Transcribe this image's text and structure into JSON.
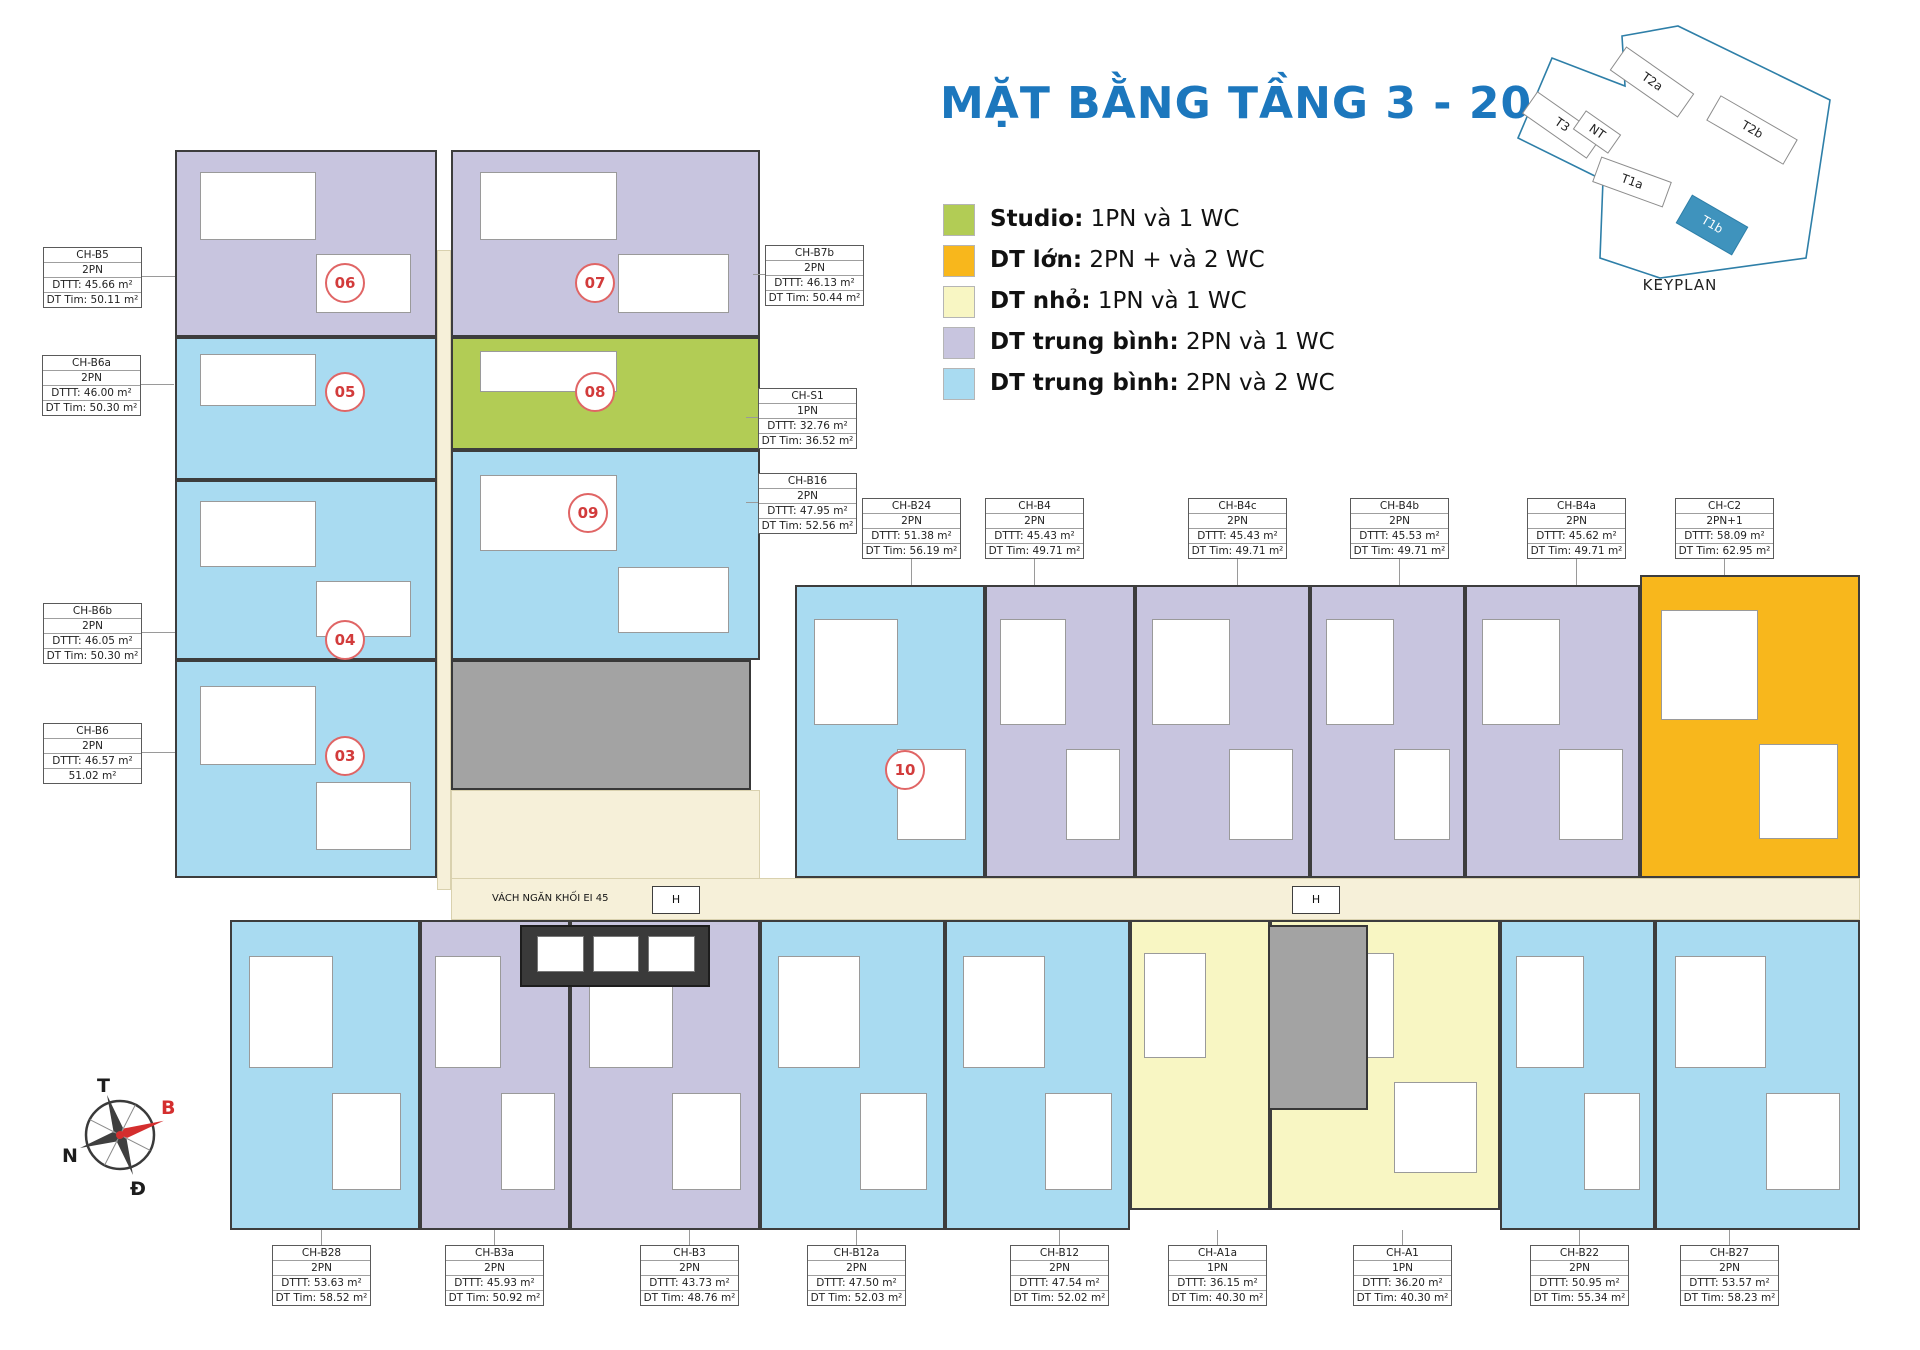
{
  "title": "MẶT BẰNG TẦNG 3 - 20",
  "title_color": "#1c77bd",
  "colors": {
    "studio": "#b2cc55",
    "large": "#f8b71c",
    "small": "#f8f6c3",
    "medium_1wc": "#c8c5df",
    "medium_2wc": "#a9dbf1",
    "core": "#a3a3a3",
    "corridor": "#f6f0d9",
    "elevator": "#3a3a3a"
  },
  "legend": {
    "items": [
      {
        "cat": "studio",
        "bold": "Studio:",
        "text": " 1PN và 1 WC"
      },
      {
        "cat": "large",
        "bold": "DT lớn:",
        "text": " 2PN + và 2 WC"
      },
      {
        "cat": "small",
        "bold": "DT nhỏ:",
        "text": " 1PN và 1 WC"
      },
      {
        "cat": "medium_1wc",
        "bold": "DT trung bình:",
        "text": " 2PN và 1 WC"
      },
      {
        "cat": "medium_2wc",
        "bold": "DT trung bình:",
        "text": " 2PN và 2 WC"
      }
    ]
  },
  "keyplan": {
    "caption": "KEYPLAN",
    "buildings": [
      "T3",
      "NT",
      "T2a",
      "T1a",
      "T2b",
      "T1b"
    ],
    "highlighted": "T1b",
    "highlight_color": "#3f93bd",
    "outline_color": "#2e7fa8"
  },
  "compass": {
    "top": "T",
    "right": "B",
    "left": "N",
    "bottom": "Đ",
    "needle_color": "#d42e2e"
  },
  "apartments": [
    {
      "id": "CH-B5",
      "type": "2PN",
      "dttt": "DTTT: 45.66 m²",
      "dttim": "DT Tim: 50.11 m²",
      "x": 43,
      "y": 247,
      "leader": "right"
    },
    {
      "id": "CH-B6a",
      "type": "2PN",
      "dttt": "DTTT: 46.00 m²",
      "dttim": "DT Tim: 50.30 m²",
      "x": 42,
      "y": 355,
      "leader": "right"
    },
    {
      "id": "CH-B6b",
      "type": "2PN",
      "dttt": "DTTT: 46.05 m²",
      "dttim": "DT Tim: 50.30 m²",
      "x": 43,
      "y": 603,
      "leader": "right"
    },
    {
      "id": "CH-B6",
      "type": "2PN",
      "dttt": "DTTT: 46.57 m²",
      "dttim": "51.02 m²",
      "x": 43,
      "y": 723,
      "leader": "right"
    },
    {
      "id": "CH-B7b",
      "type": "2PN",
      "dttt": "DTTT: 46.13 m²",
      "dttim": "DT Tim: 50.44 m²",
      "x": 765,
      "y": 245,
      "leader": "left"
    },
    {
      "id": "CH-S1",
      "type": "1PN",
      "dttt": "DTTT: 32.76 m²",
      "dttim": "DT Tim: 36.52 m²",
      "x": 758,
      "y": 388,
      "leader": "left"
    },
    {
      "id": "CH-B16",
      "type": "2PN",
      "dttt": "DTTT: 47.95 m²",
      "dttim": "DT Tim: 52.56 m²",
      "x": 758,
      "y": 473,
      "leader": "left"
    },
    {
      "id": "CH-B24",
      "type": "2PN",
      "dttt": "DTTT: 51.38 m²",
      "dttim": "DT Tim: 56.19 m²",
      "x": 862,
      "y": 498,
      "leader": "down"
    },
    {
      "id": "CH-B4",
      "type": "2PN",
      "dttt": "DTTT: 45.43 m²",
      "dttim": "DT Tim: 49.71 m²",
      "x": 985,
      "y": 498,
      "leader": "down"
    },
    {
      "id": "CH-B4c",
      "type": "2PN",
      "dttt": "DTTT: 45.43 m²",
      "dttim": "DT Tim: 49.71 m²",
      "x": 1188,
      "y": 498,
      "leader": "down"
    },
    {
      "id": "CH-B4b",
      "type": "2PN",
      "dttt": "DTTT: 45.53 m²",
      "dttim": "DT Tim: 49.71 m²",
      "x": 1350,
      "y": 498,
      "leader": "down"
    },
    {
      "id": "CH-B4a",
      "type": "2PN",
      "dttt": "DTTT: 45.62 m²",
      "dttim": "DT Tim: 49.71 m²",
      "x": 1527,
      "y": 498,
      "leader": "down"
    },
    {
      "id": "CH-C2",
      "type": "2PN+1",
      "dttt": "DTTT: 58.09 m²",
      "dttim": "DT Tim: 62.95 m²",
      "x": 1675,
      "y": 498,
      "leader": "down",
      "llen": 19
    },
    {
      "id": "CH-B28",
      "type": "2PN",
      "dttt": "DTTT: 53.63 m²",
      "dttim": "DT Tim: 58.52 m²",
      "x": 272,
      "y": 1245,
      "leader": "up"
    },
    {
      "id": "CH-B3a",
      "type": "2PN",
      "dttt": "DTTT: 45.93 m²",
      "dttim": "DT Tim: 50.92 m²",
      "x": 445,
      "y": 1245,
      "leader": "up"
    },
    {
      "id": "CH-B3",
      "type": "2PN",
      "dttt": "DTTT: 43.73 m²",
      "dttim": "DT Tim: 48.76 m²",
      "x": 640,
      "y": 1245,
      "leader": "up"
    },
    {
      "id": "CH-B12a",
      "type": "2PN",
      "dttt": "DTTT: 47.50 m²",
      "dttim": "DT Tim: 52.03 m²",
      "x": 807,
      "y": 1245,
      "leader": "up"
    },
    {
      "id": "CH-B12",
      "type": "2PN",
      "dttt": "DTTT: 47.54 m²",
      "dttim": "DT Tim: 52.02 m²",
      "x": 1010,
      "y": 1245,
      "leader": "up"
    },
    {
      "id": "CH-A1a",
      "type": "1PN",
      "dttt": "DTTT: 36.15 m²",
      "dttim": "DT Tim: 40.30 m²",
      "x": 1168,
      "y": 1245,
      "leader": "up"
    },
    {
      "id": "CH-A1",
      "type": "1PN",
      "dttt": "DTTT: 36.20 m²",
      "dttim": "DT Tim: 40.30 m²",
      "x": 1353,
      "y": 1245,
      "leader": "up"
    },
    {
      "id": "CH-B22",
      "type": "2PN",
      "dttt": "DTTT: 50.95 m²",
      "dttim": "DT Tim: 55.34 m²",
      "x": 1530,
      "y": 1245,
      "leader": "up"
    },
    {
      "id": "CH-B27",
      "type": "2PN",
      "dttt": "DTTT: 53.57 m²",
      "dttim": "DT Tim: 58.23 m²",
      "x": 1680,
      "y": 1245,
      "leader": "up"
    }
  ],
  "units": [
    {
      "no": "06",
      "cat": "medium_1wc",
      "cx": 345,
      "cy": 283
    },
    {
      "no": "07",
      "cat": "medium_1wc",
      "cx": 595,
      "cy": 283
    },
    {
      "no": "05",
      "cat": "medium_2wc",
      "cx": 345,
      "cy": 392
    },
    {
      "no": "08",
      "cat": "studio",
      "cx": 595,
      "cy": 392
    },
    {
      "no": "09",
      "cat": "medium_2wc",
      "cx": 588,
      "cy": 513
    },
    {
      "no": "04",
      "cat": "medium_2wc",
      "cx": 345,
      "cy": 640
    },
    {
      "no": "03",
      "cat": "medium_2wc",
      "cx": 345,
      "cy": 756
    },
    {
      "no": "10",
      "cat": "medium_2wc",
      "cx": 905,
      "cy": 770
    },
    {
      "no": "11",
      "cat": "medium_1wc",
      "cx": 1023,
      "cy": 769
    },
    {
      "no": "12",
      "cat": "medium_1wc",
      "cx": 1210,
      "cy": 770
    },
    {
      "no": "13",
      "cat": "medium_1wc",
      "cx": 1390,
      "cy": 770
    },
    {
      "no": "14",
      "cat": "medium_1wc",
      "cx": 1555,
      "cy": 770
    },
    {
      "no": "15",
      "cat": "large",
      "cx": 1700,
      "cy": 770
    },
    {
      "no": "02",
      "cat": "medium_2wc",
      "cx": 360,
      "cy": 1010
    },
    {
      "no": "01",
      "cat": "medium_1wc",
      "cx": 492,
      "cy": 1010
    },
    {
      "no": "22",
      "cat": "medium_1wc",
      "cx": 688,
      "cy": 1010
    },
    {
      "no": "21",
      "cat": "medium_2wc",
      "cx": 855,
      "cy": 1010
    },
    {
      "no": "20",
      "cat": "medium_2wc",
      "cx": 1058,
      "cy": 1010
    },
    {
      "no": "19",
      "cat": "small",
      "cx": 1200,
      "cy": 1010
    },
    {
      "no": "18",
      "cat": "small",
      "cx": 1400,
      "cy": 1010
    },
    {
      "no": "17",
      "cat": "medium_2wc",
      "cx": 1577,
      "cy": 1010
    },
    {
      "no": "16",
      "cat": "medium_2wc",
      "cx": 1730,
      "cy": 1010
    }
  ],
  "plan": {
    "regions": [
      {
        "name": "corridor-vertical",
        "kind": "corridor",
        "cat": "corridor",
        "rect": [
          437,
          250,
          14,
          640
        ]
      },
      {
        "name": "corridor-lobby",
        "kind": "corridor",
        "cat": "corridor",
        "rect": [
          451,
          790,
          309,
          90
        ]
      },
      {
        "name": "corridor-horizontal",
        "kind": "corridor",
        "cat": "corridor",
        "rect": [
          451,
          878,
          1409,
          42
        ]
      },
      {
        "name": "unit-06-area",
        "cat": "medium_1wc",
        "rect": [
          175,
          150,
          262,
          187
        ]
      },
      {
        "name": "unit-07-area",
        "cat": "medium_1wc",
        "rect": [
          451,
          150,
          309,
          187
        ]
      },
      {
        "name": "unit-05-area",
        "cat": "medium_2wc",
        "rect": [
          175,
          337,
          262,
          143
        ]
      },
      {
        "name": "unit-08-area",
        "cat": "studio",
        "rect": [
          451,
          337,
          309,
          113
        ]
      },
      {
        "name": "unit-04-area",
        "cat": "medium_2wc",
        "rect": [
          175,
          480,
          262,
          180
        ]
      },
      {
        "name": "unit-09-area",
        "cat": "medium_2wc",
        "rect": [
          451,
          450,
          309,
          210
        ]
      },
      {
        "name": "unit-03-area",
        "cat": "medium_2wc",
        "rect": [
          175,
          660,
          262,
          218
        ]
      },
      {
        "name": "core-top",
        "kind": "core",
        "cat": "core",
        "rect": [
          451,
          660,
          300,
          130
        ]
      },
      {
        "name": "unit-10-area",
        "cat": "medium_2wc",
        "rect": [
          795,
          585,
          190,
          293
        ]
      },
      {
        "name": "unit-11-area",
        "cat": "medium_1wc",
        "rect": [
          985,
          585,
          150,
          293
        ]
      },
      {
        "name": "unit-12-area",
        "cat": "medium_1wc",
        "rect": [
          1135,
          585,
          175,
          293
        ]
      },
      {
        "name": "unit-13-area",
        "cat": "medium_1wc",
        "rect": [
          1310,
          585,
          155,
          293
        ]
      },
      {
        "name": "unit-14-area",
        "cat": "medium_1wc",
        "rect": [
          1465,
          585,
          175,
          293
        ]
      },
      {
        "name": "unit-15-area",
        "cat": "large",
        "rect": [
          1640,
          575,
          220,
          303
        ]
      },
      {
        "name": "unit-02-area",
        "cat": "medium_2wc",
        "rect": [
          230,
          920,
          190,
          310
        ]
      },
      {
        "name": "unit-01-area",
        "cat": "medium_1wc",
        "rect": [
          420,
          920,
          150,
          310
        ]
      },
      {
        "name": "unit-22-area",
        "cat": "medium_1wc",
        "rect": [
          570,
          920,
          190,
          310
        ]
      },
      {
        "name": "unit-21-area",
        "cat": "medium_2wc",
        "rect": [
          760,
          920,
          185,
          310
        ]
      },
      {
        "name": "unit-20-area",
        "cat": "medium_2wc",
        "rect": [
          945,
          920,
          185,
          310
        ]
      },
      {
        "name": "unit-19-area",
        "cat": "small",
        "rect": [
          1130,
          920,
          140,
          290
        ]
      },
      {
        "name": "unit-18-area",
        "cat": "small",
        "rect": [
          1270,
          920,
          230,
          290
        ]
      },
      {
        "name": "core-bottom",
        "kind": "core",
        "cat": "core",
        "rect": [
          1268,
          925,
          100,
          185
        ]
      },
      {
        "name": "unit-17-area",
        "cat": "medium_2wc",
        "rect": [
          1500,
          920,
          155,
          310
        ]
      },
      {
        "name": "unit-16-area",
        "cat": "medium_2wc",
        "rect": [
          1655,
          920,
          205,
          310
        ]
      },
      {
        "name": "elevator-bank",
        "kind": "elev",
        "cat": "elevator",
        "rect": [
          520,
          925,
          190,
          62
        ]
      }
    ],
    "stairs": [
      [
        565,
        662,
        85,
        55
      ],
      [
        1283,
        1015,
        72,
        60
      ]
    ],
    "shafts": [
      [
        655,
        700,
        60,
        70
      ]
    ],
    "texts": [
      {
        "t": "THANG N1\nTHAY THẾ",
        "x": 600,
        "y": 663,
        "s": 9,
        "w": 100,
        "a": "center"
      },
      {
        "t": "S=6,8m2",
        "x": 487,
        "y": 716,
        "s": 10,
        "w": 70,
        "a": "left"
      },
      {
        "t": "HK",
        "x": 416,
        "y": 812,
        "s": 9,
        "w": 30,
        "a": "left"
      },
      {
        "t": "VÁCH NGĂN KHỐI EI 45",
        "x": 492,
        "y": 893,
        "s": 10,
        "w": 170,
        "a": "left"
      },
      {
        "t": "S=3m2",
        "x": 1312,
        "y": 938,
        "s": 9,
        "w": 50,
        "a": "left"
      },
      {
        "t": "HK",
        "x": 1274,
        "y": 956,
        "s": 9,
        "w": 30,
        "a": "left"
      },
      {
        "t": "THANG N1\nTHAY THẾ",
        "x": 1282,
        "y": 983,
        "s": 8.5,
        "w": 80,
        "a": "center"
      }
    ],
    "boxes": [
      {
        "t": "H",
        "x": 508,
        "y": 692,
        "w": 46,
        "h": 24,
        "s": 11
      },
      {
        "t": "H",
        "x": 652,
        "y": 886,
        "w": 46,
        "h": 26,
        "s": 11
      },
      {
        "t": "H",
        "x": 1292,
        "y": 886,
        "w": 46,
        "h": 26,
        "s": 11
      },
      {
        "t": "THANG MÁY\nPCCC",
        "x": 453,
        "y": 738,
        "w": 74,
        "h": 44,
        "s": 8,
        "bg": "#c2c2c2"
      }
    ]
  }
}
